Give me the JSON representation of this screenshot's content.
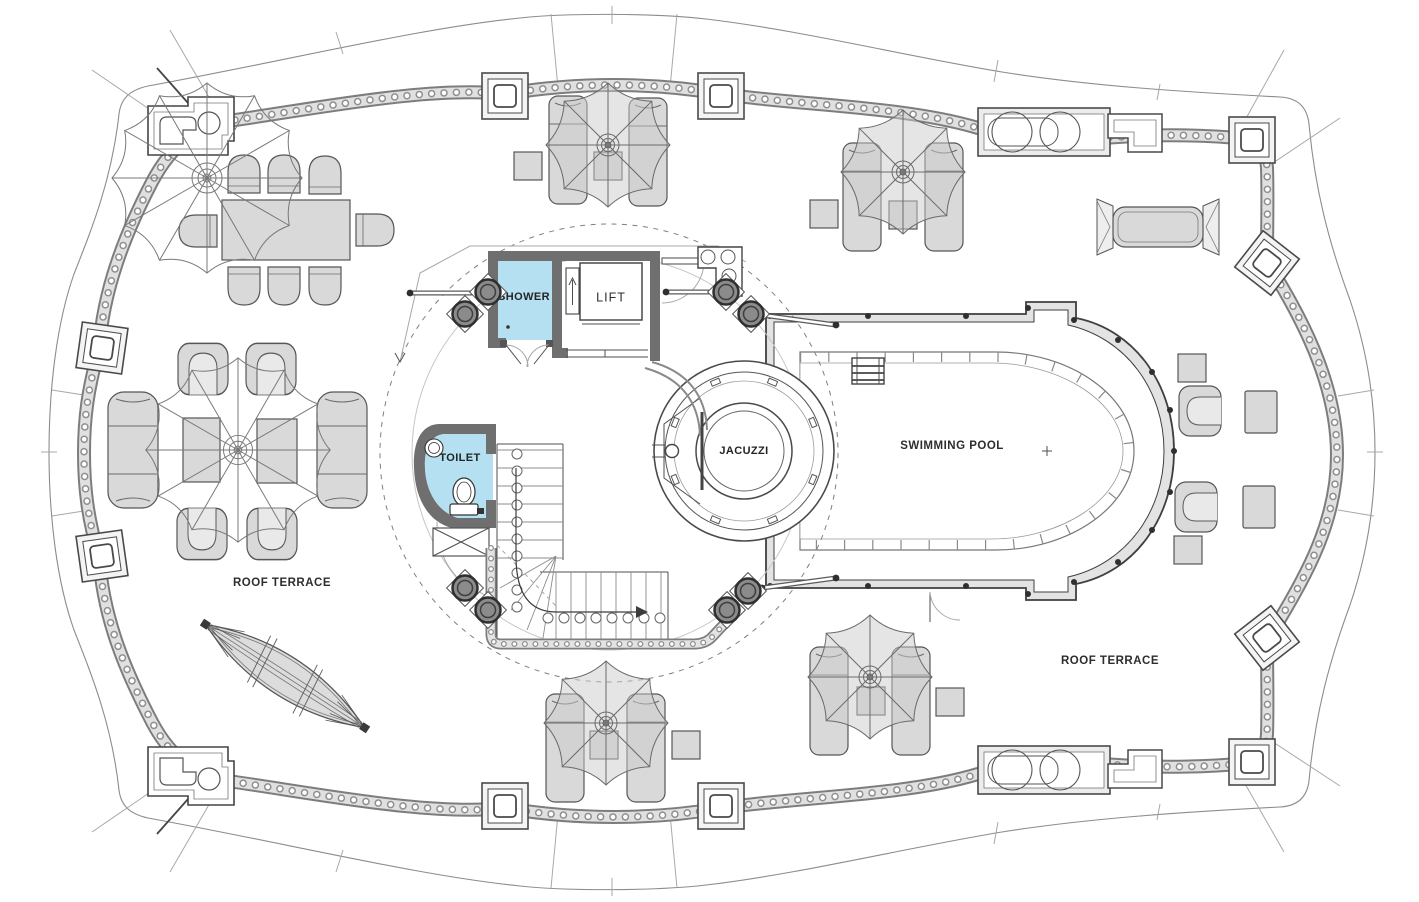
{
  "plan": {
    "labels": {
      "shower": "SHOWER",
      "lift": "LIFT",
      "toilet": "TOILET",
      "jacuzzi": "JACUZZI",
      "swimming_pool": "SWIMMING POOL",
      "roof_terrace_left": "ROOF TERRACE",
      "roof_terrace_right": "ROOF TERRACE"
    },
    "colors": {
      "room_blue": "#b5e0f1",
      "furniture_gray": "#d9d9d9",
      "wall_gray": "#6f6f6f",
      "line_dark": "#4a4a4a",
      "balustrade_gray": "#8f8f8f",
      "background": "#ffffff"
    }
  }
}
